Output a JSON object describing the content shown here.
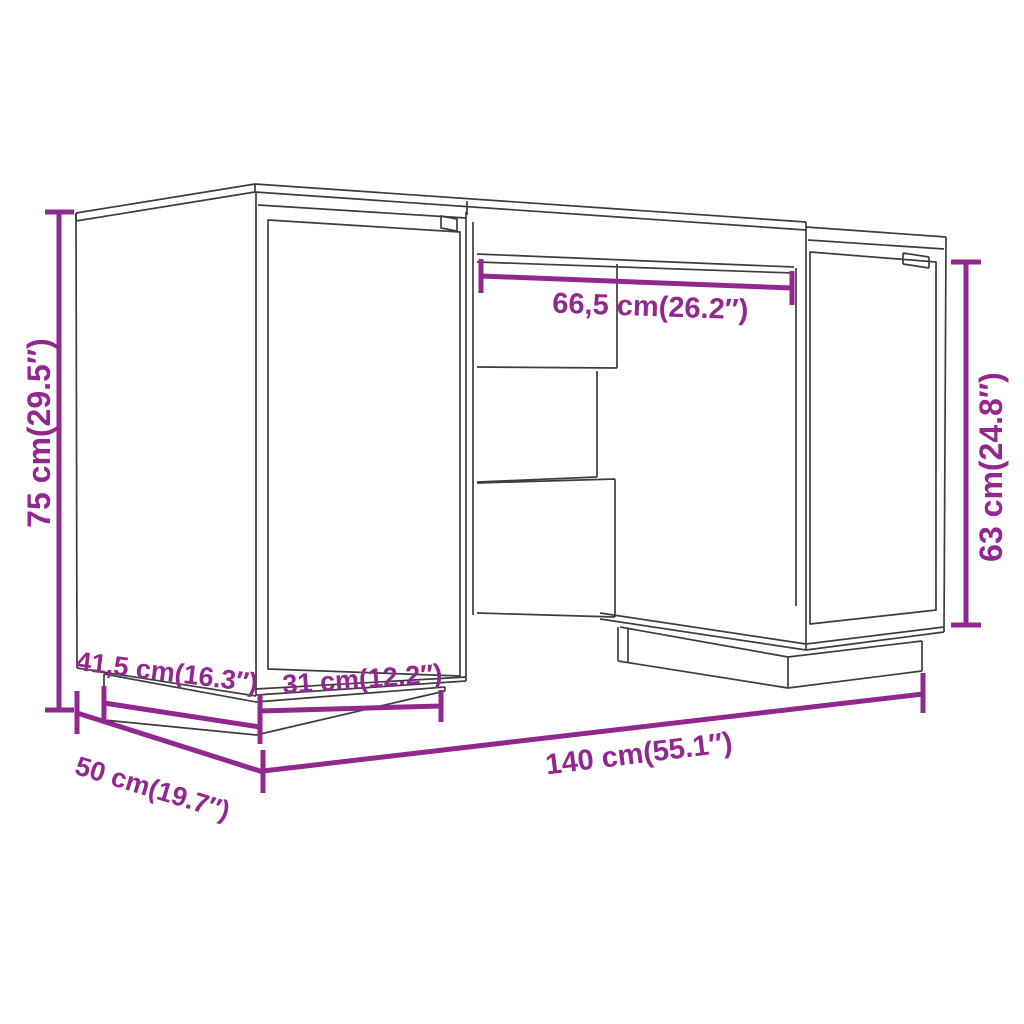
{
  "diagram": {
    "subject": "desk with two cabinets - dimension drawing",
    "colors": {
      "dimension": "#92278F",
      "outline": "#3d3d3d",
      "background": "#ffffff"
    },
    "labels": {
      "height": "75 cm(29.5″)",
      "kneehole_width": "66,5 cm(26.2″)",
      "cabinet_height": "63 cm(24.8″)",
      "plinth_depth": "41,5 cm(16.3″)",
      "door_width": "31 cm(12.2″)",
      "depth": "50 cm(19.7″)",
      "width": "140 cm(55.1″)"
    }
  }
}
